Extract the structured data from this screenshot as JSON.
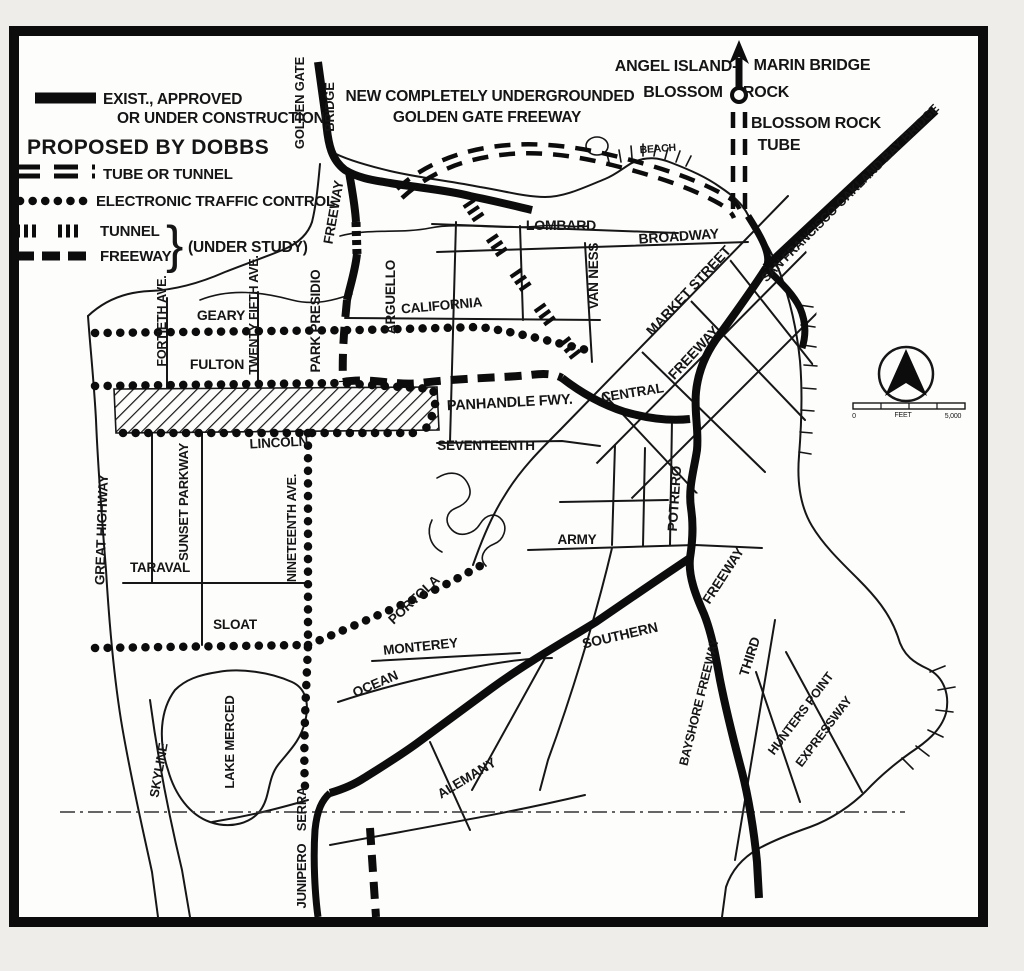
{
  "colors": {
    "ink": "#111111",
    "paper": "#efede9",
    "map_background": "#fdfdfc"
  },
  "legend": {
    "exist_line1": "EXIST., APPROVED",
    "exist_line2": "OR UNDER CONSTRUCTION",
    "heading": "PROPOSED BY DOBBS",
    "tube_or_tunnel": "TUBE OR TUNNEL",
    "electronic": "ELECTRONIC TRAFFIC CONTROL",
    "tunnel": "TUNNEL",
    "freeway": "FREEWAY",
    "brace": "}",
    "under_study": "(UNDER STUDY)"
  },
  "scale_bar": {
    "zero": "0",
    "unit": "FEET",
    "max": "5,000"
  },
  "map": {
    "labels": {
      "golden_gate": "GOLDEN GATE",
      "bridge": "BRIDGE",
      "new_gg_1": "NEW COMPLETELY UNDERGROUNDED",
      "new_gg_2": "GOLDEN GATE FREEWAY",
      "angel_island": "ANGEL ISLAND-",
      "marin_bridge": "MARIN BRIDGE",
      "blossom": "BLOSSOM",
      "rock": "ROCK",
      "blossom_rock": "BLOSSOM ROCK",
      "tube": "TUBE",
      "bay_bridge": "SAN FRANCISCO-OAKLAND BAY BRIDGE",
      "beach": "BEACH",
      "lombard": "LOMBARD",
      "broadway": "BROADWAY",
      "market_street": "MARKET STREET",
      "freeway_market": "FREEWAY",
      "van_ness": "VAN NESS",
      "california": "CALIFORNIA",
      "arguello": "ARGUELLO",
      "park_presidio": "PARK PRESIDIO",
      "freeway_presidio": "FREEWAY",
      "geary": "GEARY",
      "fortieth": "FORTIETH AVE.",
      "twenty_fifth": "TWENTY FIFTH AVE.",
      "fulton": "FULTON",
      "panhandle": "PANHANDLE FWY.",
      "central": "CENTRAL",
      "seventeenth": "SEVENTEENTH",
      "lincoln": "LINCOLN",
      "nineteenth": "NINETEENTH AVE.",
      "great_highway": "GREAT HIGHWAY",
      "sunset_parkway": "SUNSET PARKWAY",
      "taraval": "TARAVAL",
      "army": "ARMY",
      "potrero": "POTRERO",
      "freeway_bayshore": "FREEWAY",
      "southern": "SOUTHERN",
      "third": "THIRD",
      "bayshore_freeway": "BAYSHORE FREEWAY",
      "hunters_point": "HUNTERS POINT",
      "expressway": "EXPRESSWAY",
      "sloat": "SLOAT",
      "monterey": "MONTEREY",
      "ocean": "OCEAN",
      "portola": "PORTOLA",
      "alemany": "ALEMANY",
      "lake_merced": "LAKE MERCED",
      "skyline": "SKYLINE",
      "serra": "SERRA",
      "junipero": "JUNIPERO"
    }
  }
}
